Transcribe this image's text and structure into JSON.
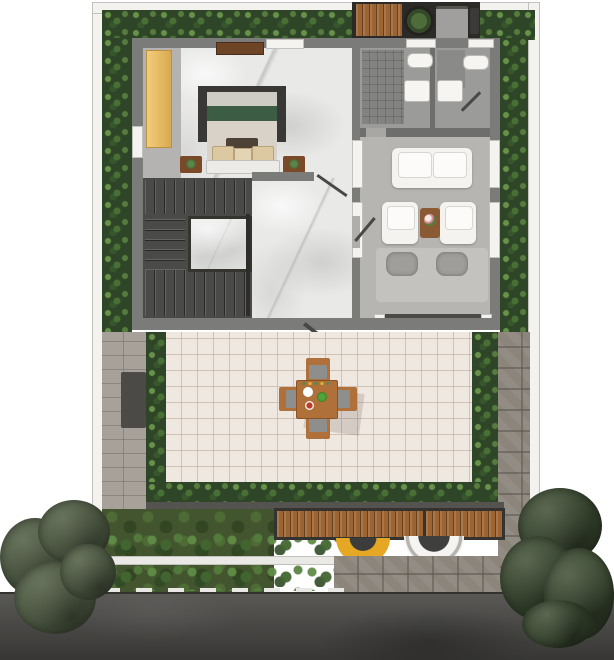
{
  "scene": {
    "type": "architectural floor plan, top-down render, no text labels",
    "areas": {
      "bedroom": {
        "label": "bedroom",
        "furniture": [
          "wardrobe",
          "dresser",
          "double bed with green runner",
          "breakfast tray",
          "foot bench",
          "nightstand left",
          "nightstand right"
        ]
      },
      "hallway": {
        "label": "marble hallway"
      },
      "staircase": {
        "label": "u-shaped staircase with marble core"
      },
      "bathroom_1": {
        "label": "bathroom",
        "fixtures": [
          "shower",
          "toilet",
          "washbasin"
        ]
      },
      "bathroom_2": {
        "label": "bathroom",
        "fixtures": [
          "toilet",
          "washbasin",
          "door swing"
        ]
      },
      "living_room": {
        "label": "living room",
        "furniture": [
          "white sofa",
          "armchair left",
          "armchair right",
          "coffee table with flowers",
          "grey daybed with two cushions",
          "sliding glass door"
        ]
      },
      "terrace": {
        "label": "tiled terrace",
        "furniture": [
          "square dining table",
          "chair north",
          "chair south",
          "chair west",
          "chair east"
        ],
        "tableware": [
          "white plate",
          "green bowl",
          "red plate"
        ]
      },
      "garden": {
        "label": "garden strip",
        "elements": [
          "perimeter hedge",
          "shrub beds",
          "lawn",
          "dark planter",
          "timber deck",
          "yellow awning",
          "white awning",
          "stone path",
          "street trees"
        ]
      },
      "roof_items": {
        "label": "service strip",
        "elements": [
          "timber deck",
          "potted plant",
          "ac unit",
          "small unit"
        ]
      },
      "street": {
        "label": "asphalt road with dashed edge line"
      }
    }
  },
  "colors": {
    "background": "#ffffff",
    "boundary_wall": "#f3f2ef",
    "hedge": "#2f4527",
    "building_wall": "#7b7b79",
    "wall_dark": "#6e6e6c",
    "marble_floor": "#e9eae8",
    "bedroom_carpet": "#b4b3b1",
    "wardrobe": "#ecc470",
    "dresser": "#6e4426",
    "bed_frame": "#3a3836",
    "bed_linen": "#d8d2c8",
    "bed_green": "#3d5c44",
    "stair": "#4a4a48",
    "bathroom_floor": "#9b9b99",
    "shower": "#838382",
    "living_floor": "#b7b5b2",
    "sofa_white": "#f4f3f0",
    "daybed": "#c4c2bf",
    "daybed_cushion": "#a09e9b",
    "terrace_tile": "#efe8e0",
    "walkway_paver": "#a7a199",
    "planter": "#4b4a47",
    "deck_wood": "#9c6433",
    "deck_frame": "#35332f",
    "dining_wood": "#b0703a",
    "chair_seat": "#8e8e8c",
    "plate_white": "#ffffff",
    "bowl_green": "#4fa53a",
    "plate_red": "#c03a2a",
    "awning_yellow": "#e5a724",
    "awning_white": "#f5f4f1",
    "stone_path": "#8b857c",
    "grass": "#42552f",
    "garden_wall": "#eae9e6",
    "tree_left": "#4d5943",
    "tree_right": "#36442e",
    "road": "#4b4a47",
    "road_marking": "#e9e8e4",
    "service_strip": "#2b2a27",
    "ac_unit": "#a09f9d"
  }
}
